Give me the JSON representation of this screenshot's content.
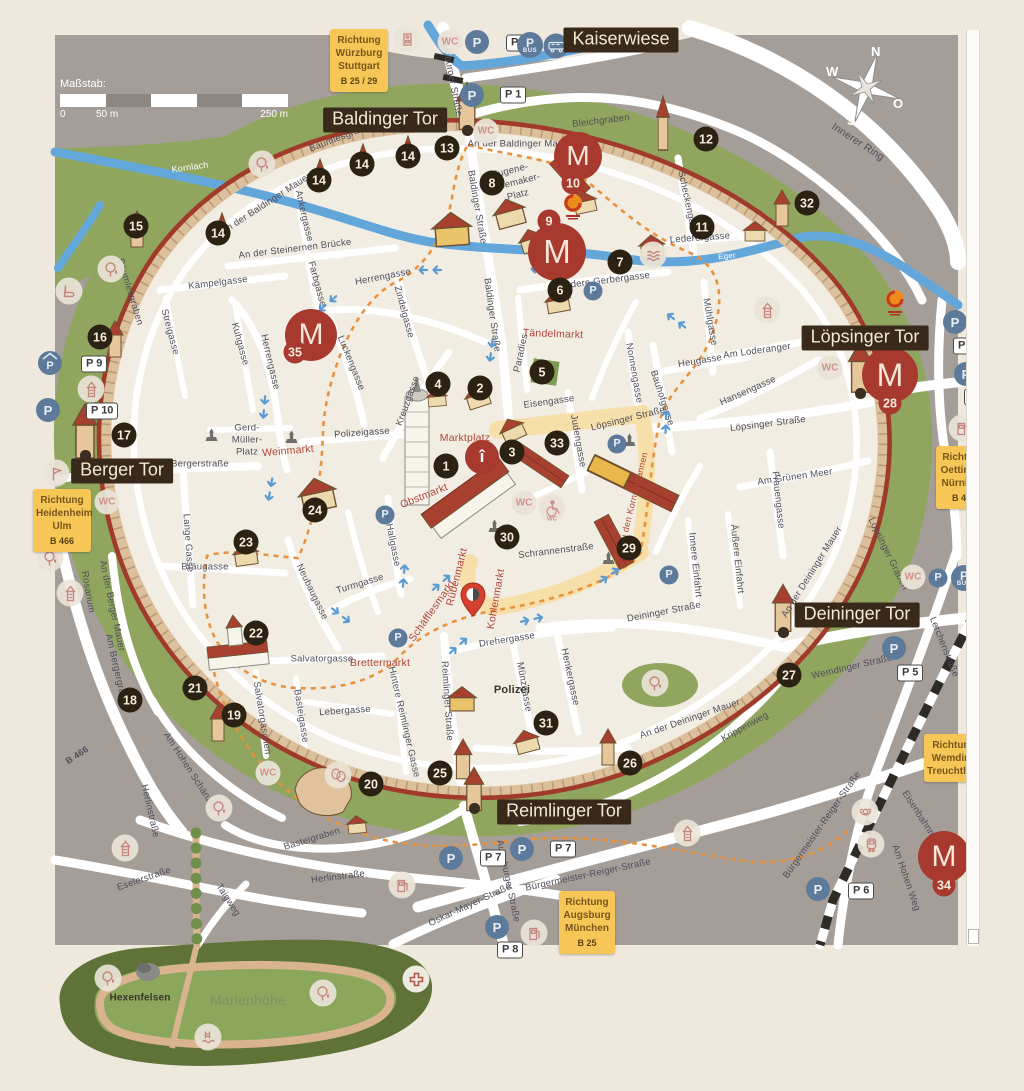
{
  "scale": {
    "title": "Maßstab:",
    "zero": "0",
    "fifty": "50 m",
    "twofifty": "250 m"
  },
  "compass": {
    "n": "N",
    "w": "W",
    "o": "O",
    "s": "S"
  },
  "glyphs": {
    "museum": "M",
    "parking": "P",
    "bus": "BUS",
    "wc": "WC",
    "info": "î"
  },
  "gates": [
    {
      "text": "Kaiserwiese",
      "x": 621,
      "y": 40
    },
    {
      "text": "Baldinger Tor",
      "x": 385,
      "y": 120
    },
    {
      "text": "Löpsinger Tor",
      "x": 865,
      "y": 338
    },
    {
      "text": "Berger Tor",
      "x": 122,
      "y": 471
    },
    {
      "text": "Deininger Tor",
      "x": 857,
      "y": 615
    },
    {
      "text": "Reimlinger Tor",
      "x": 564,
      "y": 812
    }
  ],
  "signs": [
    {
      "x": 330,
      "y": 29,
      "w": 52,
      "lines": [
        "Richtung",
        "Würzburg",
        "Stuttgart"
      ],
      "route": "B 25 / 29"
    },
    {
      "x": 33,
      "y": 489,
      "w": 52,
      "lines": [
        "Richtung",
        "Heidenheim",
        "Ulm"
      ],
      "route": "B 466"
    },
    {
      "x": 936,
      "y": 446,
      "w": 50,
      "lines": [
        "Richtung",
        "Oettingen",
        "Nürnberg"
      ],
      "route": "B 466"
    },
    {
      "x": 924,
      "y": 734,
      "w": 54,
      "lines": [
        "Richtung",
        "Wemding",
        "Treuchtlingen"
      ],
      "route": ""
    },
    {
      "x": 559,
      "y": 891,
      "w": 50,
      "lines": [
        "Richtung",
        "Augsburg",
        "München"
      ],
      "route": "B 25"
    }
  ],
  "labels": [
    {
      "t": "Würzburger Straße",
      "x": 451,
      "y": 75,
      "r": 79
    },
    {
      "t": "Bleichgraben",
      "x": 601,
      "y": 121,
      "r": -7
    },
    {
      "t": "Innerer Ring",
      "x": 858,
      "y": 142,
      "r": 33,
      "s": 10.5
    },
    {
      "t": "Bäumlesgraben",
      "x": 342,
      "y": 137,
      "r": -21
    },
    {
      "t": "An der Baldinger Mauer",
      "x": 520,
      "y": 144,
      "r": 0
    },
    {
      "t": "An der Baldinger Mauer",
      "x": 266,
      "y": 204,
      "r": -33
    },
    {
      "t": "Bäumlesgraben",
      "x": 130,
      "y": 292,
      "r": 73
    },
    {
      "t": "Ankergasse",
      "x": 304,
      "y": 216,
      "r": 77
    },
    {
      "t": "Baldinger Straße",
      "x": 477,
      "y": 207,
      "r": 80
    },
    {
      "t": "Baldinger Straße",
      "x": 492,
      "y": 315,
      "r": 82
    },
    {
      "t": "Scheckengasse",
      "x": 688,
      "y": 205,
      "r": 78
    },
    {
      "t": "Lederergasse",
      "x": 700,
      "y": 238,
      "r": -4
    },
    {
      "t": "Vordere Gerbergasse",
      "x": 603,
      "y": 281,
      "r": -7
    },
    {
      "t": "An der Steinernen Brücke",
      "x": 295,
      "y": 249,
      "r": -7
    },
    {
      "t": "Kämpelgasse",
      "x": 218,
      "y": 283,
      "r": -7
    },
    {
      "t": "Herrengasse",
      "x": 383,
      "y": 277,
      "r": -11
    },
    {
      "t": "Herrengasse",
      "x": 270,
      "y": 362,
      "r": 77
    },
    {
      "t": "Farbgasse",
      "x": 317,
      "y": 284,
      "r": 75
    },
    {
      "t": "Zindelgasse",
      "x": 404,
      "y": 312,
      "r": 75
    },
    {
      "t": "Streigasse",
      "x": 170,
      "y": 332,
      "r": 75
    },
    {
      "t": "Kuhgasse",
      "x": 240,
      "y": 344,
      "r": 75
    },
    {
      "t": "Luckengasse",
      "x": 351,
      "y": 363,
      "r": 68
    },
    {
      "t": "Kreuzgasse",
      "x": 408,
      "y": 401,
      "r": -70
    },
    {
      "t": "Paradies",
      "x": 521,
      "y": 353,
      "r": -78
    },
    {
      "t": "Mühlgasse",
      "x": 710,
      "y": 322,
      "r": 80
    },
    {
      "t": "Heugasse",
      "x": 700,
      "y": 361,
      "r": -9
    },
    {
      "t": "Am Loderanger",
      "x": 757,
      "y": 351,
      "r": -8
    },
    {
      "t": "Hansengasse",
      "x": 748,
      "y": 391,
      "r": -24
    },
    {
      "t": "Nonnengasse",
      "x": 634,
      "y": 373,
      "r": 80
    },
    {
      "t": "Bauhofgasse",
      "x": 662,
      "y": 398,
      "r": 72
    },
    {
      "t": "Eisengasse",
      "x": 549,
      "y": 402,
      "r": -8
    },
    {
      "t": "Löpsinger Straße",
      "x": 628,
      "y": 419,
      "r": -14
    },
    {
      "t": "Löpsinger Straße",
      "x": 768,
      "y": 424,
      "r": -7
    },
    {
      "t": "Judengasse",
      "x": 578,
      "y": 441,
      "r": 80
    },
    {
      "t": "Polizeigasse",
      "x": 362,
      "y": 433,
      "r": -4
    },
    {
      "t": "Bergerstraße",
      "x": 200,
      "y": 464,
      "r": 0
    },
    {
      "t": "Am Grünen Meer",
      "x": 795,
      "y": 477,
      "r": -8
    },
    {
      "t": "Frauengasse",
      "x": 778,
      "y": 500,
      "r": 84
    },
    {
      "t": "Lange Gasse",
      "x": 188,
      "y": 543,
      "r": 86
    },
    {
      "t": "Innere Einfahrt",
      "x": 695,
      "y": 565,
      "r": 84
    },
    {
      "t": "Äußere Einfahrt",
      "x": 737,
      "y": 559,
      "r": 84
    },
    {
      "t": "Schrannenstraße",
      "x": 556,
      "y": 551,
      "r": -7
    },
    {
      "t": "Löpsinger Graben",
      "x": 888,
      "y": 554,
      "r": 64
    },
    {
      "t": "An der Deininger Mauer",
      "x": 812,
      "y": 572,
      "r": -58
    },
    {
      "t": "Bräugasse",
      "x": 205,
      "y": 567,
      "r": 0
    },
    {
      "t": "Neubaugasse",
      "x": 312,
      "y": 592,
      "r": 64
    },
    {
      "t": "Turmgasse",
      "x": 360,
      "y": 584,
      "r": -17
    },
    {
      "t": "Hallgasse",
      "x": 393,
      "y": 545,
      "r": 79
    },
    {
      "t": "Rosarium",
      "x": 88,
      "y": 592,
      "r": 80
    },
    {
      "t": "An der Berger Mauer",
      "x": 112,
      "y": 606,
      "r": 78
    },
    {
      "t": "Am Bergergraben",
      "x": 117,
      "y": 672,
      "r": 77
    },
    {
      "t": "Deininger Straße",
      "x": 664,
      "y": 612,
      "r": -11
    },
    {
      "t": "Wemdinger Straße",
      "x": 852,
      "y": 667,
      "r": -13
    },
    {
      "t": "Lerchenstraße",
      "x": 944,
      "y": 647,
      "r": 68
    },
    {
      "t": "Drehergasse",
      "x": 507,
      "y": 640,
      "r": -9
    },
    {
      "t": "Salvatorgasse",
      "x": 322,
      "y": 659,
      "r": 0
    },
    {
      "t": "Salvatorgäschen",
      "x": 262,
      "y": 718,
      "r": 81
    },
    {
      "t": "Basteigasse",
      "x": 301,
      "y": 716,
      "r": 81
    },
    {
      "t": "Lebergasse",
      "x": 345,
      "y": 711,
      "r": -4
    },
    {
      "t": "Hintere Reimlinger Gasse",
      "x": 404,
      "y": 722,
      "r": 77
    },
    {
      "t": "Reimlinger Straße",
      "x": 447,
      "y": 701,
      "r": 86
    },
    {
      "t": "Münzgasse",
      "x": 524,
      "y": 687,
      "r": 80
    },
    {
      "t": "Henkergasse",
      "x": 570,
      "y": 677,
      "r": 78
    },
    {
      "t": "An der Deininger Mauer",
      "x": 690,
      "y": 719,
      "r": -19
    },
    {
      "t": "Krippenweg",
      "x": 745,
      "y": 727,
      "r": -29
    },
    {
      "t": "Am Hohen Schänzle",
      "x": 190,
      "y": 771,
      "r": 57
    },
    {
      "t": "Herlinstraße",
      "x": 150,
      "y": 811,
      "r": 77
    },
    {
      "t": "Basteigraben",
      "x": 312,
      "y": 839,
      "r": -17
    },
    {
      "t": "Eselerstraße",
      "x": 144,
      "y": 879,
      "r": -19
    },
    {
      "t": "Taigweg",
      "x": 228,
      "y": 900,
      "r": 57
    },
    {
      "t": "Herlinstraße",
      "x": 338,
      "y": 877,
      "r": -7
    },
    {
      "t": "Oskar-Mayer-Straße",
      "x": 470,
      "y": 905,
      "r": -25
    },
    {
      "t": "Augsburger Straße",
      "x": 508,
      "y": 881,
      "r": 78
    },
    {
      "t": "Bürgermeister-Reiger-Straße",
      "x": 588,
      "y": 875,
      "r": -12
    },
    {
      "t": "Bürgermeister-Reiger-Straße",
      "x": 822,
      "y": 825,
      "r": -55
    },
    {
      "t": "Am Hohen Weg",
      "x": 906,
      "y": 878,
      "r": 71
    },
    {
      "t": "Eisenbahnmuseum",
      "x": 927,
      "y": 827,
      "r": 57
    },
    {
      "t": "Gerd-",
      "x": 247,
      "y": 428,
      "r": 0
    },
    {
      "t": "Müller-",
      "x": 247,
      "y": 440,
      "r": 0
    },
    {
      "t": "Platz",
      "x": 247,
      "y": 452,
      "r": 0
    },
    {
      "t": "Eugene-",
      "x": 510,
      "y": 171,
      "r": -14
    },
    {
      "t": "Shoemaker-",
      "x": 514,
      "y": 183,
      "r": -14
    },
    {
      "t": "Platz",
      "x": 518,
      "y": 195,
      "r": -14
    },
    {
      "t": "Marktplatz",
      "x": 465,
      "y": 438,
      "r": 0,
      "c": "rd"
    },
    {
      "t": "Weinmarkt",
      "x": 288,
      "y": 451,
      "r": -5,
      "c": "rd"
    },
    {
      "t": "Obstmarkt",
      "x": 424,
      "y": 496,
      "r": -22,
      "c": "rd"
    },
    {
      "t": "Tändelmarkt",
      "x": 553,
      "y": 334,
      "r": 2,
      "c": "rd"
    },
    {
      "t": "Brettermarkt",
      "x": 380,
      "y": 663,
      "r": 0,
      "c": "rd"
    },
    {
      "t": "Rübenmarkt",
      "x": 457,
      "y": 577,
      "r": -76,
      "c": "rd"
    },
    {
      "t": "Kohlenmarkt",
      "x": 496,
      "y": 599,
      "r": -80,
      "c": "rd"
    },
    {
      "t": "Schäfflesmarkt",
      "x": 432,
      "y": 611,
      "r": -55,
      "c": "rd"
    },
    {
      "t": "Bei den Kornschrannen",
      "x": 633,
      "y": 500,
      "r": -76,
      "c": "rd",
      "s": 9
    },
    {
      "t": "Kornlach",
      "x": 190,
      "y": 167,
      "r": -8,
      "c": "wt"
    },
    {
      "t": "Eger",
      "x": 340,
      "y": 255,
      "r": -5,
      "c": "wt",
      "s": 8
    },
    {
      "t": "Eger",
      "x": 727,
      "y": 256,
      "r": -5,
      "c": "wt",
      "s": 8
    },
    {
      "t": "Polizei",
      "x": 512,
      "y": 690,
      "r": 0,
      "c": "bk",
      "s": 11
    },
    {
      "t": "Hexenfelsen",
      "x": 140,
      "y": 998,
      "r": 0,
      "c": "bk",
      "s": 10
    },
    {
      "t": "Marienhöhe",
      "x": 248,
      "y": 1000,
      "r": 0,
      "c": "gr"
    },
    {
      "t": "B 466",
      "x": 77,
      "y": 755,
      "r": -33,
      "c": "bd",
      "s": 9
    }
  ],
  "markers": [
    {
      "n": "1",
      "x": 446,
      "y": 466
    },
    {
      "n": "2",
      "x": 480,
      "y": 388
    },
    {
      "n": "3",
      "x": 512,
      "y": 452
    },
    {
      "n": "4",
      "x": 438,
      "y": 384
    },
    {
      "n": "5",
      "x": 542,
      "y": 372
    },
    {
      "n": "6",
      "x": 560,
      "y": 290
    },
    {
      "n": "7",
      "x": 620,
      "y": 262
    },
    {
      "n": "8",
      "x": 492,
      "y": 183
    },
    {
      "n": "11",
      "x": 702,
      "y": 227
    },
    {
      "n": "12",
      "x": 706,
      "y": 139
    },
    {
      "n": "13",
      "x": 447,
      "y": 148
    },
    {
      "n": "14",
      "x": 218,
      "y": 233
    },
    {
      "n": "14",
      "x": 319,
      "y": 180
    },
    {
      "n": "14",
      "x": 362,
      "y": 164
    },
    {
      "n": "14",
      "x": 408,
      "y": 156
    },
    {
      "n": "15",
      "x": 136,
      "y": 226
    },
    {
      "n": "16",
      "x": 100,
      "y": 337
    },
    {
      "n": "17",
      "x": 124,
      "y": 435
    },
    {
      "n": "18",
      "x": 130,
      "y": 700
    },
    {
      "n": "19",
      "x": 234,
      "y": 715
    },
    {
      "n": "20",
      "x": 371,
      "y": 784
    },
    {
      "n": "21",
      "x": 195,
      "y": 688
    },
    {
      "n": "22",
      "x": 256,
      "y": 633
    },
    {
      "n": "23",
      "x": 246,
      "y": 542
    },
    {
      "n": "24",
      "x": 315,
      "y": 510
    },
    {
      "n": "25",
      "x": 440,
      "y": 773
    },
    {
      "n": "26",
      "x": 630,
      "y": 763
    },
    {
      "n": "27",
      "x": 789,
      "y": 675
    },
    {
      "n": "29",
      "x": 629,
      "y": 548
    },
    {
      "n": "30",
      "x": 507,
      "y": 537
    },
    {
      "n": "31",
      "x": 546,
      "y": 723
    },
    {
      "n": "32",
      "x": 807,
      "y": 203
    },
    {
      "n": "33",
      "x": 557,
      "y": 443
    }
  ],
  "red_markers": [
    {
      "n": "9",
      "x": 549,
      "y": 221
    },
    {
      "n": "10",
      "x": 573,
      "y": 183
    },
    {
      "n": "28",
      "x": 890,
      "y": 403
    },
    {
      "n": "34",
      "x": 944,
      "y": 885
    },
    {
      "n": "35",
      "x": 295,
      "y": 352
    }
  ],
  "museums": [
    {
      "x": 578,
      "y": 156,
      "r": 24
    },
    {
      "x": 557,
      "y": 252,
      "r": 29
    },
    {
      "x": 311,
      "y": 335,
      "r": 26
    },
    {
      "x": 890,
      "y": 375,
      "r": 28
    },
    {
      "x": 944,
      "y": 857,
      "r": 26
    }
  ],
  "geopark_logos": [
    {
      "x": 573,
      "y": 207
    },
    {
      "x": 895,
      "y": 303
    }
  ],
  "parkings": [
    {
      "l": "P 1",
      "cx": 472,
      "cy": 95,
      "lx": 500,
      "ly": 95
    },
    {
      "l": "P 2",
      "cx": 477,
      "cy": 42,
      "lx": 506,
      "ly": 43
    },
    {
      "l": "P 3",
      "cx": 955,
      "cy": 322,
      "lx": 953,
      "ly": 346
    },
    {
      "l": "P 4",
      "cx": 966,
      "cy": 374,
      "lx": 964,
      "ly": 397
    },
    {
      "l": "P 5",
      "cx": 894,
      "cy": 648,
      "lx": 897,
      "ly": 673
    },
    {
      "l": "P 6",
      "cx": 818,
      "cy": 889,
      "lx": 848,
      "ly": 891
    },
    {
      "l": "P 7",
      "cx": 451,
      "cy": 858,
      "lx": 480,
      "ly": 858
    },
    {
      "l": "P 7",
      "cx": 522,
      "cy": 849,
      "lx": 550,
      "ly": 849
    },
    {
      "l": "P 8",
      "cx": 497,
      "cy": 927,
      "lx": 497,
      "ly": 950
    },
    {
      "l": "P 9",
      "cx": 50,
      "cy": 363,
      "lx": 81,
      "ly": 364,
      "roof": true
    },
    {
      "l": "P 10",
      "cx": 48,
      "cy": 410,
      "lx": 86,
      "ly": 411
    }
  ],
  "bus_parkings": [
    {
      "x": 530,
      "y": 45
    },
    {
      "x": 964,
      "y": 578
    }
  ],
  "camper": {
    "x": 556,
    "y": 46
  },
  "plain_parkings": [
    [
      385,
      515
    ],
    [
      398,
      638
    ],
    [
      617,
      444
    ],
    [
      669,
      575
    ],
    [
      938,
      578
    ],
    [
      593,
      291
    ]
  ],
  "wcs": [
    [
      450,
      42
    ],
    [
      486,
      131
    ],
    [
      830,
      368
    ],
    [
      524,
      503
    ],
    [
      107,
      502
    ],
    [
      268,
      773
    ],
    [
      913,
      577
    ]
  ],
  "wheelchair": {
    "x": 552,
    "y": 508
  },
  "amenities": [
    {
      "i": "machine",
      "x": 407,
      "y": 39
    },
    {
      "i": "tree",
      "x": 262,
      "y": 164
    },
    {
      "i": "tree",
      "x": 111,
      "y": 269
    },
    {
      "i": "skate",
      "x": 69,
      "y": 291
    },
    {
      "i": "tower",
      "x": 91,
      "y": 389
    },
    {
      "i": "flag",
      "x": 56,
      "y": 473
    },
    {
      "i": "tree",
      "x": 50,
      "y": 558
    },
    {
      "i": "tower",
      "x": 70,
      "y": 593
    },
    {
      "i": "tower",
      "x": 125,
      "y": 848
    },
    {
      "i": "tree",
      "x": 219,
      "y": 808
    },
    {
      "i": "masks",
      "x": 338,
      "y": 775
    },
    {
      "i": "tower",
      "x": 687,
      "y": 833
    },
    {
      "i": "tree",
      "x": 655,
      "y": 683
    },
    {
      "i": "tower",
      "x": 767,
      "y": 310
    },
    {
      "i": "fuel",
      "x": 402,
      "y": 885
    },
    {
      "i": "fuel",
      "x": 534,
      "y": 933
    },
    {
      "i": "fuel",
      "x": 962,
      "y": 428
    },
    {
      "i": "horn",
      "x": 865,
      "y": 812
    },
    {
      "i": "train",
      "x": 871,
      "y": 844
    },
    {
      "i": "cross",
      "x": 416,
      "y": 979
    },
    {
      "i": "tree",
      "x": 108,
      "y": 978
    },
    {
      "i": "tree",
      "x": 323,
      "y": 993
    },
    {
      "i": "pool",
      "x": 208,
      "y": 1037
    },
    {
      "i": "waves",
      "x": 653,
      "y": 255
    },
    {
      "i": "fountain",
      "x": 211,
      "y": 435
    },
    {
      "i": "fountain",
      "x": 291,
      "y": 437
    },
    {
      "i": "fountain",
      "x": 629,
      "y": 440
    },
    {
      "i": "fountain",
      "x": 608,
      "y": 558
    },
    {
      "i": "fountain",
      "x": 494,
      "y": 526
    }
  ],
  "arrows": [
    {
      "x": 428,
      "y": 268,
      "a": 180
    },
    {
      "x": 540,
      "y": 267,
      "a": 180
    },
    {
      "x": 325,
      "y": 303,
      "a": 140
    },
    {
      "x": 489,
      "y": 352,
      "a": 97
    },
    {
      "x": 676,
      "y": 318,
      "a": 217
    },
    {
      "x": 668,
      "y": 420,
      "a": -88
    },
    {
      "x": 406,
      "y": 574,
      "a": -85
    },
    {
      "x": 444,
      "y": 583,
      "a": -40
    },
    {
      "x": 341,
      "y": 618,
      "a": 38
    },
    {
      "x": 534,
      "y": 621,
      "a": -12
    },
    {
      "x": 461,
      "y": 646,
      "a": -42
    },
    {
      "x": 612,
      "y": 576,
      "a": -35
    },
    {
      "x": 262,
      "y": 409,
      "a": 95
    },
    {
      "x": 268,
      "y": 491,
      "a": 100
    }
  ],
  "pin": {
    "x": 473,
    "y": 600
  },
  "info": {
    "x": 482,
    "y": 457
  }
}
